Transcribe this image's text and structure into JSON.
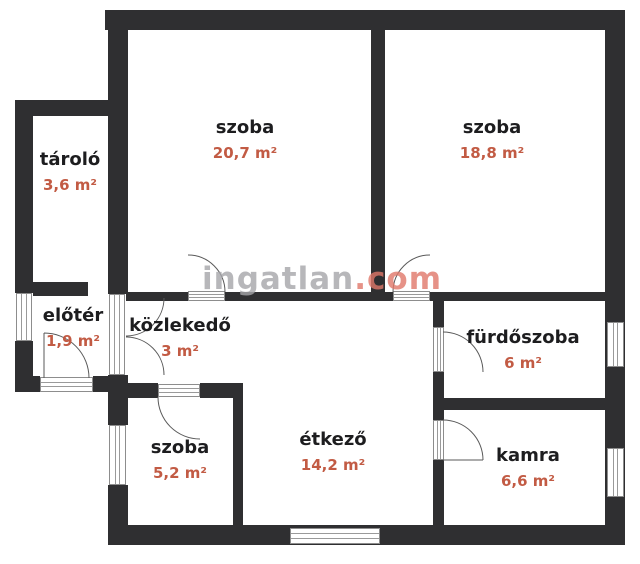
{
  "watermark": {
    "name": "ingatlan",
    "tld": ".com"
  },
  "colors": {
    "wall": "#2f2f31",
    "room_name": "#1d1d1f",
    "area_accent": "#c25b44",
    "watermark_gray": "#a6a6aa",
    "watermark_salmon": "#e0786a"
  },
  "rooms": [
    {
      "id": "szoba-1",
      "name": "szoba",
      "area": "20,7 m²"
    },
    {
      "id": "szoba-2",
      "name": "szoba",
      "area": "18,8 m²"
    },
    {
      "id": "tarolo",
      "name": "tároló",
      "area": "3,6 m²"
    },
    {
      "id": "eloter",
      "name": "előtér",
      "area": "1,9 m²"
    },
    {
      "id": "kozlekedo",
      "name": "közlekedő",
      "area": "3 m²"
    },
    {
      "id": "furdoszoba",
      "name": "fürdőszoba",
      "area": "6 m²"
    },
    {
      "id": "szoba-3",
      "name": "szoba",
      "area": "5,2 m²"
    },
    {
      "id": "etkezo",
      "name": "étkező",
      "area": "14,2 m²"
    },
    {
      "id": "kamra",
      "name": "kamra",
      "area": "6,6 m²"
    }
  ]
}
